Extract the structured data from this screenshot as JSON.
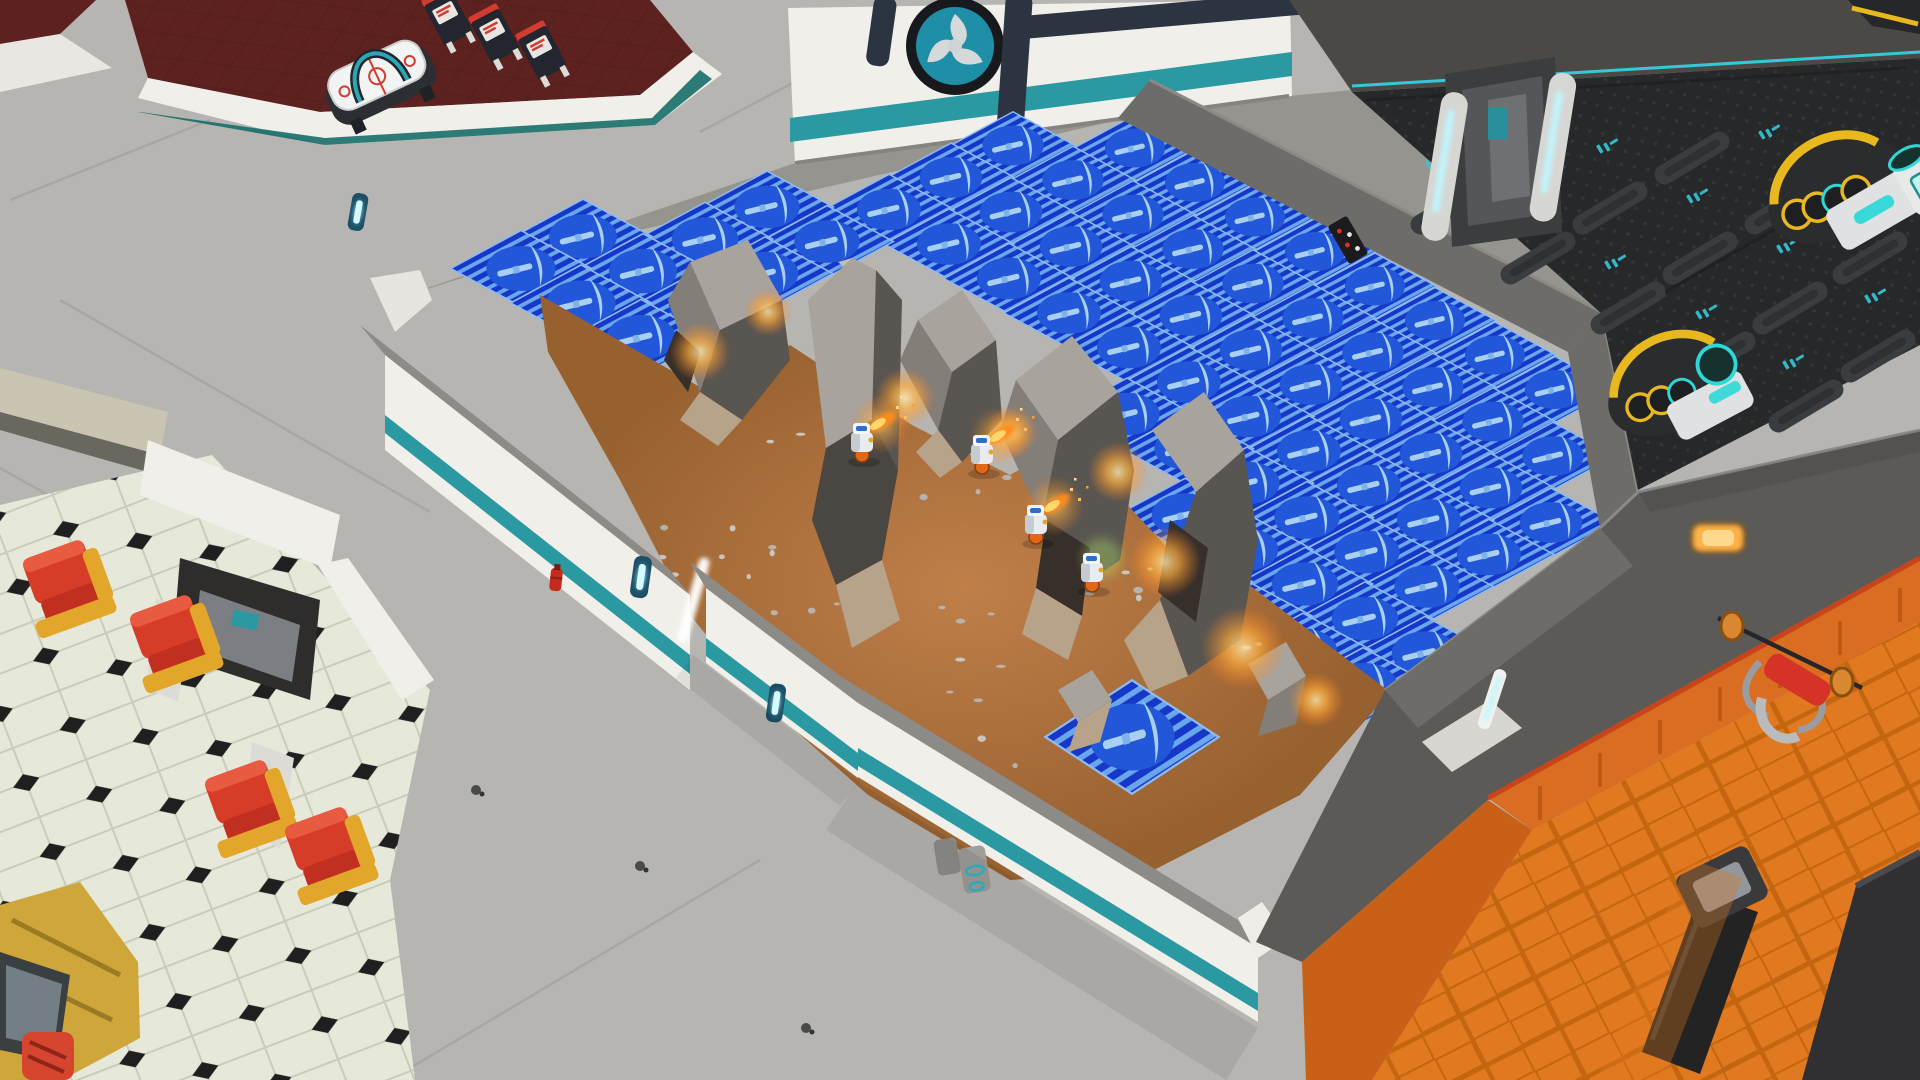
{
  "scene": {
    "name": "colony-base-overhead-view",
    "view": "isometric-3d",
    "rooms": {
      "games_lounge": {
        "floor": "dark-red-carpet",
        "objects": [
          "air-hockey-table",
          "arcade-machines"
        ]
      },
      "diner": {
        "floor": "octagon-checker",
        "objects": [
          "booth-chairs",
          "snack-machine",
          "wall-recess-machine"
        ]
      },
      "generator_room": {
        "floor": "dark-hex-plate",
        "objects": [
          "generators",
          "sliding-door",
          "hazard-sign"
        ]
      },
      "gym": {
        "floor": "orange-parquet",
        "objects": [
          "weight-bench",
          "barbell",
          "treadmill",
          "wall-lamp"
        ]
      },
      "mining_site": {
        "floor": "dirt",
        "objects": [
          "rock-formations",
          "ore-veins",
          "miner-bots",
          "fire-extinguisher",
          "wall-lamps",
          "wall-device"
        ]
      }
    }
  },
  "palette": {
    "teal": "#2b99a1",
    "teal_dark": "#176e69",
    "corridor": "#b7b5b2",
    "corridor_line": "#a5a3a0",
    "wall_white": "#f1efe9",
    "wall_cap": "#e2e0da",
    "wall_inner": "#cfcdc7",
    "concrete": "#96948f",
    "dark_wall": "#6e6c68",
    "dark_wall2": "#5c5a56",
    "carpet": "#5d2220",
    "dirt": "#ad6f3c",
    "rock_light": "#a8a39d",
    "rock_mid": "#837e78",
    "rock_dark": "#595550",
    "rock_tan": "#b7a28a",
    "rock_crevice": "#362f2a",
    "tile_base": "#1638c8",
    "tile_stripe": "#6aa6ec",
    "tile_circle": "#2157d8",
    "tile_glyph": "#a9cff2",
    "tile_border": "#8fbaee",
    "tech_floor": "#26282a",
    "tech_band": "#4b4946",
    "tech_accent": "#35c8d8",
    "machine_yellow": "#e8b81f",
    "gym_floor": "#e0791f",
    "gym_line": "#c4660f",
    "gym_wainscot": "#d96d22",
    "gym_trim": "#c8441a",
    "chair_red": "#d63c28",
    "chair_yellow": "#e2a62a",
    "diner_floor": "#e6e8da",
    "diner_black": "#1f1f1f",
    "diner_seam": "#c9ccba",
    "lamp_blue": "#8fe7ff",
    "lamp_amber": "#ffb347",
    "ore": "#ff9f1f",
    "flame": "#ffd76a"
  },
  "mining_overlay": {
    "icon": "pickaxe-icon",
    "origin": [
      1135,
      148
    ],
    "u": [
      60,
      34.5
    ],
    "v": [
      -62,
      32
    ],
    "half_diag": [
      61,
      33
    ],
    "rows": [
      {
        "r": 0,
        "cols": [
          0,
          1,
          2,
          3,
          4,
          5,
          6,
          7
        ]
      },
      {
        "r": 1,
        "cols": [
          -1,
          0,
          1,
          2,
          3,
          4,
          5,
          6,
          7,
          8
        ]
      },
      {
        "r": 2,
        "cols": [
          -1,
          0,
          1,
          2,
          3,
          4,
          5,
          6,
          7,
          8,
          9
        ]
      },
      {
        "r": 3,
        "cols": [
          -1,
          0,
          1,
          2,
          3,
          4,
          5,
          6,
          7,
          8,
          9
        ]
      },
      {
        "r": 4,
        "cols": [
          -2,
          -1,
          4,
          5,
          6,
          7,
          8,
          9
        ]
      },
      {
        "r": 5,
        "cols": [
          -2,
          -1,
          6,
          7,
          8,
          9,
          10
        ]
      },
      {
        "r": 6,
        "cols": [
          -3,
          -2,
          -1,
          7,
          8,
          9,
          10
        ]
      },
      {
        "r": 7,
        "cols": [
          -3,
          -2,
          -1
        ]
      }
    ],
    "lone_tile": {
      "center": [
        1132,
        737
      ],
      "sx": 1.42,
      "sy": 1.72
    }
  },
  "miners": [
    {
      "x": 862,
      "y": 440,
      "flame": true,
      "green_glow": false
    },
    {
      "x": 982,
      "y": 452,
      "flame": true,
      "green_glow": false
    },
    {
      "x": 1036,
      "y": 522,
      "flame": true,
      "green_glow": false
    },
    {
      "x": 1092,
      "y": 570,
      "flame": false,
      "green_glow": true
    }
  ],
  "ore_glows": [
    [
      700,
      352,
      30
    ],
    [
      768,
      312,
      24
    ],
    [
      905,
      398,
      30
    ],
    [
      1012,
      432,
      26
    ],
    [
      1118,
      472,
      30
    ],
    [
      1165,
      562,
      36
    ],
    [
      1243,
      648,
      42
    ],
    [
      1316,
      700,
      28
    ]
  ],
  "props": {
    "ridge_bars": [
      [
        1448,
        208
      ],
      [
        1538,
        258
      ],
      [
        1628,
        308
      ],
      [
        1718,
        358
      ],
      [
        1806,
        406
      ],
      [
        1520,
        158
      ],
      [
        1610,
        208
      ],
      [
        1700,
        258
      ],
      [
        1790,
        308
      ],
      [
        1878,
        356
      ],
      [
        1692,
        158
      ],
      [
        1782,
        208
      ],
      [
        1870,
        258
      ]
    ],
    "tech_marks": [
      [
        1425,
        162
      ],
      [
        1516,
        212
      ],
      [
        1604,
        262
      ],
      [
        1695,
        312
      ],
      [
        1782,
        362
      ],
      [
        1596,
        146
      ],
      [
        1686,
        196
      ],
      [
        1776,
        246
      ],
      [
        1864,
        296
      ],
      [
        1758,
        132
      ],
      [
        1848,
        182
      ]
    ],
    "floor_seams": [
      [
        60,
        300,
        430,
        512
      ],
      [
        0,
        468,
        320,
        648
      ],
      [
        210,
        120,
        10,
        200
      ],
      [
        1660,
        1080,
        1920,
        932
      ],
      [
        390,
        1080,
        760,
        860
      ],
      [
        836,
        60,
        700,
        132
      ]
    ],
    "specks": [
      [
        476,
        790
      ],
      [
        806,
        1028
      ],
      [
        640,
        866
      ]
    ],
    "diner_chairs": [
      [
        68,
        595
      ],
      [
        175,
        650
      ],
      [
        250,
        815
      ],
      [
        330,
        862
      ]
    ],
    "arcade_cabinets": [
      [
        448,
        18
      ],
      [
        495,
        35
      ],
      [
        542,
        52
      ]
    ]
  }
}
